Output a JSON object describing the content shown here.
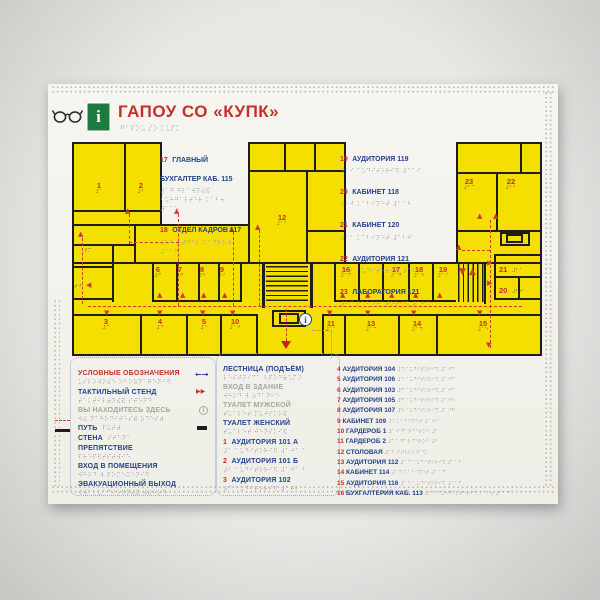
{
  "title": {
    "text": "ГАПОУ СО «КУПК»",
    "braille_src": "гапоу со купк"
  },
  "icons": {
    "info": "i",
    "legend_span_arrows": "←→",
    "tactile_stand_marker": "▶▶",
    "stairs_up": "▲",
    "stairs_down": "▼"
  },
  "palette": {
    "accent_red": "#c2302a",
    "text_blue": "#24418c",
    "muted_gray": "#a7a5a0",
    "floor_yellow": "#f5df00",
    "wall_black": "#1d1d1d",
    "route_red": "#cf3a30",
    "braille_gray": "#8a92a2",
    "info_green": "#1e7b3f",
    "panel": "#f4f3ee"
  },
  "legend": {
    "title": "УСЛОВНЫЕ ОБОЗНАЧЕНИЯ",
    "items": [
      {
        "label": "ТАКТИЛЬНЫЙ СТЕНД"
      },
      {
        "label": "ВЫ НАХОДИТЕСЬ ЗДЕСЬ"
      },
      {
        "label": "ПУТЬ"
      },
      {
        "label": "СТЕНА"
      },
      {
        "label": "ПРЕПЯТСТВИЕ"
      },
      {
        "label": "ВХОД В ПОМЕЩЕНИЯ"
      },
      {
        "label": "ЭВАКУАЦИОННЫЙ ВЫХОД"
      }
    ]
  },
  "facilities": [
    {
      "label": "ЛЕСТНИЦА (ПОДЪЁМ)"
    },
    {
      "label": "ВХОД В ЗДАНИЕ"
    },
    {
      "label": "ТУАЛЕТ МУЖСКОЙ"
    },
    {
      "label": "ТУАЛЕТ ЖЕНСКИЙ"
    }
  ],
  "room_list_small": [
    {
      "num": "1",
      "name": "АУДИТОРИЯ 101 А"
    },
    {
      "num": "2",
      "name": "АУДИТОРИЯ 101 Б"
    },
    {
      "num": "3",
      "name": "АУДИТОРИЯ 102"
    }
  ],
  "room_list": [
    {
      "num": "4",
      "name": "АУДИТОРИЯ 104"
    },
    {
      "num": "5",
      "name": "АУДИТОРИЯ 106"
    },
    {
      "num": "6",
      "name": "АУДИТОРИЯ 103"
    },
    {
      "num": "7",
      "name": "АУДИТОРИЯ 105"
    },
    {
      "num": "8",
      "name": "АУДИТОРИЯ 107"
    },
    {
      "num": "9",
      "name": "КАБИНЕТ 109"
    },
    {
      "num": "10",
      "name": "ГАРДЕРОБ 1"
    },
    {
      "num": "11",
      "name": "ГАРДЕРОБ 2"
    },
    {
      "num": "12",
      "name": "СТОЛОВАЯ"
    },
    {
      "num": "13",
      "name": "АУДИТОРИЯ 112"
    },
    {
      "num": "14",
      "name": "КАБИНЕТ 114"
    },
    {
      "num": "15",
      "name": "АУДИТОРИЯ 116"
    },
    {
      "num": "16",
      "name": "БУХГАЛТЕРИЯ КАБ. 113"
    }
  ],
  "annotations_left": [
    {
      "num": "17",
      "name": "ГЛАВНЫЙ БУХГАЛТЕР КАБ. 115"
    },
    {
      "num": "18",
      "name": "ОТДЕЛ КАДРОВ 117"
    }
  ],
  "annotations_right": [
    {
      "num": "19",
      "name": "АУДИТОРИЯ 119"
    },
    {
      "num": "20",
      "name": "КАБИНЕТ 118"
    },
    {
      "num": "21",
      "name": "КАБИНЕТ 120"
    },
    {
      "num": "22",
      "name": "АУДИТОРИЯ 121"
    },
    {
      "num": "23",
      "name": "ЛАБОРАТОРИЯ 121"
    }
  ],
  "plan": {
    "rooms": {
      "r1": "1",
      "r2": "2",
      "r3": "3",
      "r4": "4",
      "r5": "5",
      "r6": "6",
      "r7": "7",
      "r8": "8",
      "r9": "9",
      "r10": "10",
      "r11": "11",
      "r12": "12",
      "r13": "13",
      "r14": "14",
      "r15": "15",
      "r16": "16",
      "r17": "17",
      "r18": "18",
      "r19": "19",
      "r20": "20",
      "r21": "21",
      "r22": "22",
      "r23": "23"
    },
    "wc_marks": [
      "тм",
      "тж"
    ]
  }
}
